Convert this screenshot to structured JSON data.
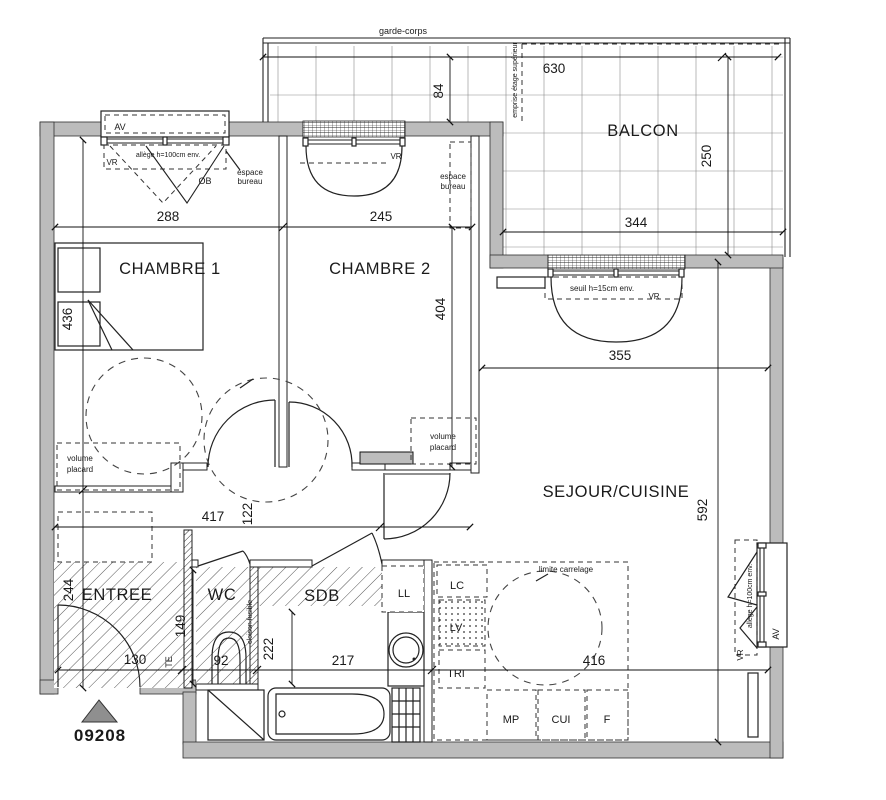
{
  "plan": {
    "number": "09208",
    "rooms": {
      "chambre1": "CHAMBRE 1",
      "chambre2": "CHAMBRE 2",
      "balcon": "BALCON",
      "sejour_cuisine": "SEJOUR/CUISINE",
      "entree": "ENTREE",
      "wc": "WC",
      "sdb": "SDB"
    },
    "dims": {
      "d288": "288",
      "d245": "245",
      "d630": "630",
      "d84": "84",
      "d250": "250",
      "d344": "344",
      "d436": "436",
      "d404": "404",
      "d355": "355",
      "d592": "592",
      "d417": "417",
      "d122": "122",
      "d244": "244",
      "d130": "130",
      "d149": "149",
      "d92": "92",
      "d222": "222",
      "d217": "217",
      "d416": "416"
    },
    "ann": {
      "garde_corps": "garde-corps",
      "emprise": "emprise étage supérieur",
      "av": "AV",
      "vr": "VR",
      "ob": "OB",
      "allege": "allège h=100cm env.",
      "seuil": "seuil h=15cm env.",
      "espace_l1": "espace",
      "espace_l2": "bureau",
      "volume_l1": "volume",
      "volume_l2": "placard",
      "limite": "limite carrelage",
      "cloison": "cloison fusible",
      "te": "TE"
    },
    "appliances": {
      "lc": "LC",
      "lv": "LV",
      "tri": "TRI",
      "mp": "MP",
      "cui": "CUI",
      "f": "F",
      "ll": "LL"
    },
    "colors": {
      "wall_fill": "#bcbcbc",
      "line": "#1a1a1a",
      "paper": "#ffffff"
    }
  }
}
